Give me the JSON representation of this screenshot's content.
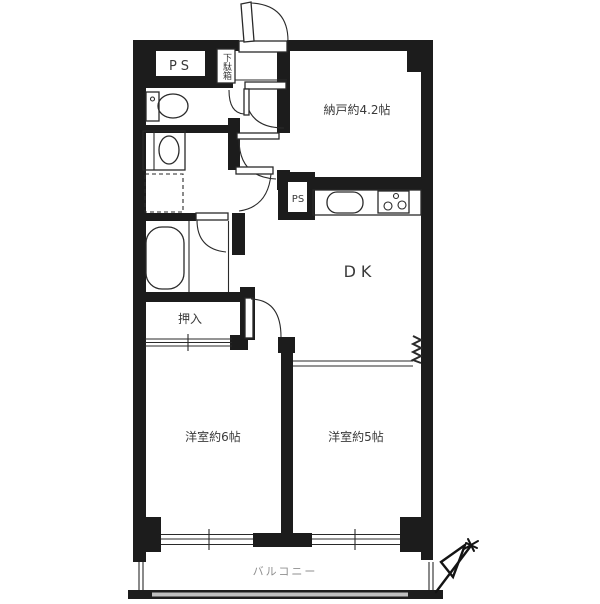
{
  "rooms": {
    "nando": "納戸約4.2帖",
    "dk": "DK",
    "western6": "洋室約6帖",
    "western5": "洋室約5帖",
    "closet": "押入",
    "balcony": "バルコニー"
  },
  "labels": {
    "ps_top": "PS",
    "ps_kitchen": "PS",
    "shoe_cabinet": "下駄箱"
  },
  "colors": {
    "wall": "#1c1c1c",
    "line": "#2a2a2a",
    "label": "#3a3a3a",
    "balcony_label": "#8f8f8f"
  }
}
